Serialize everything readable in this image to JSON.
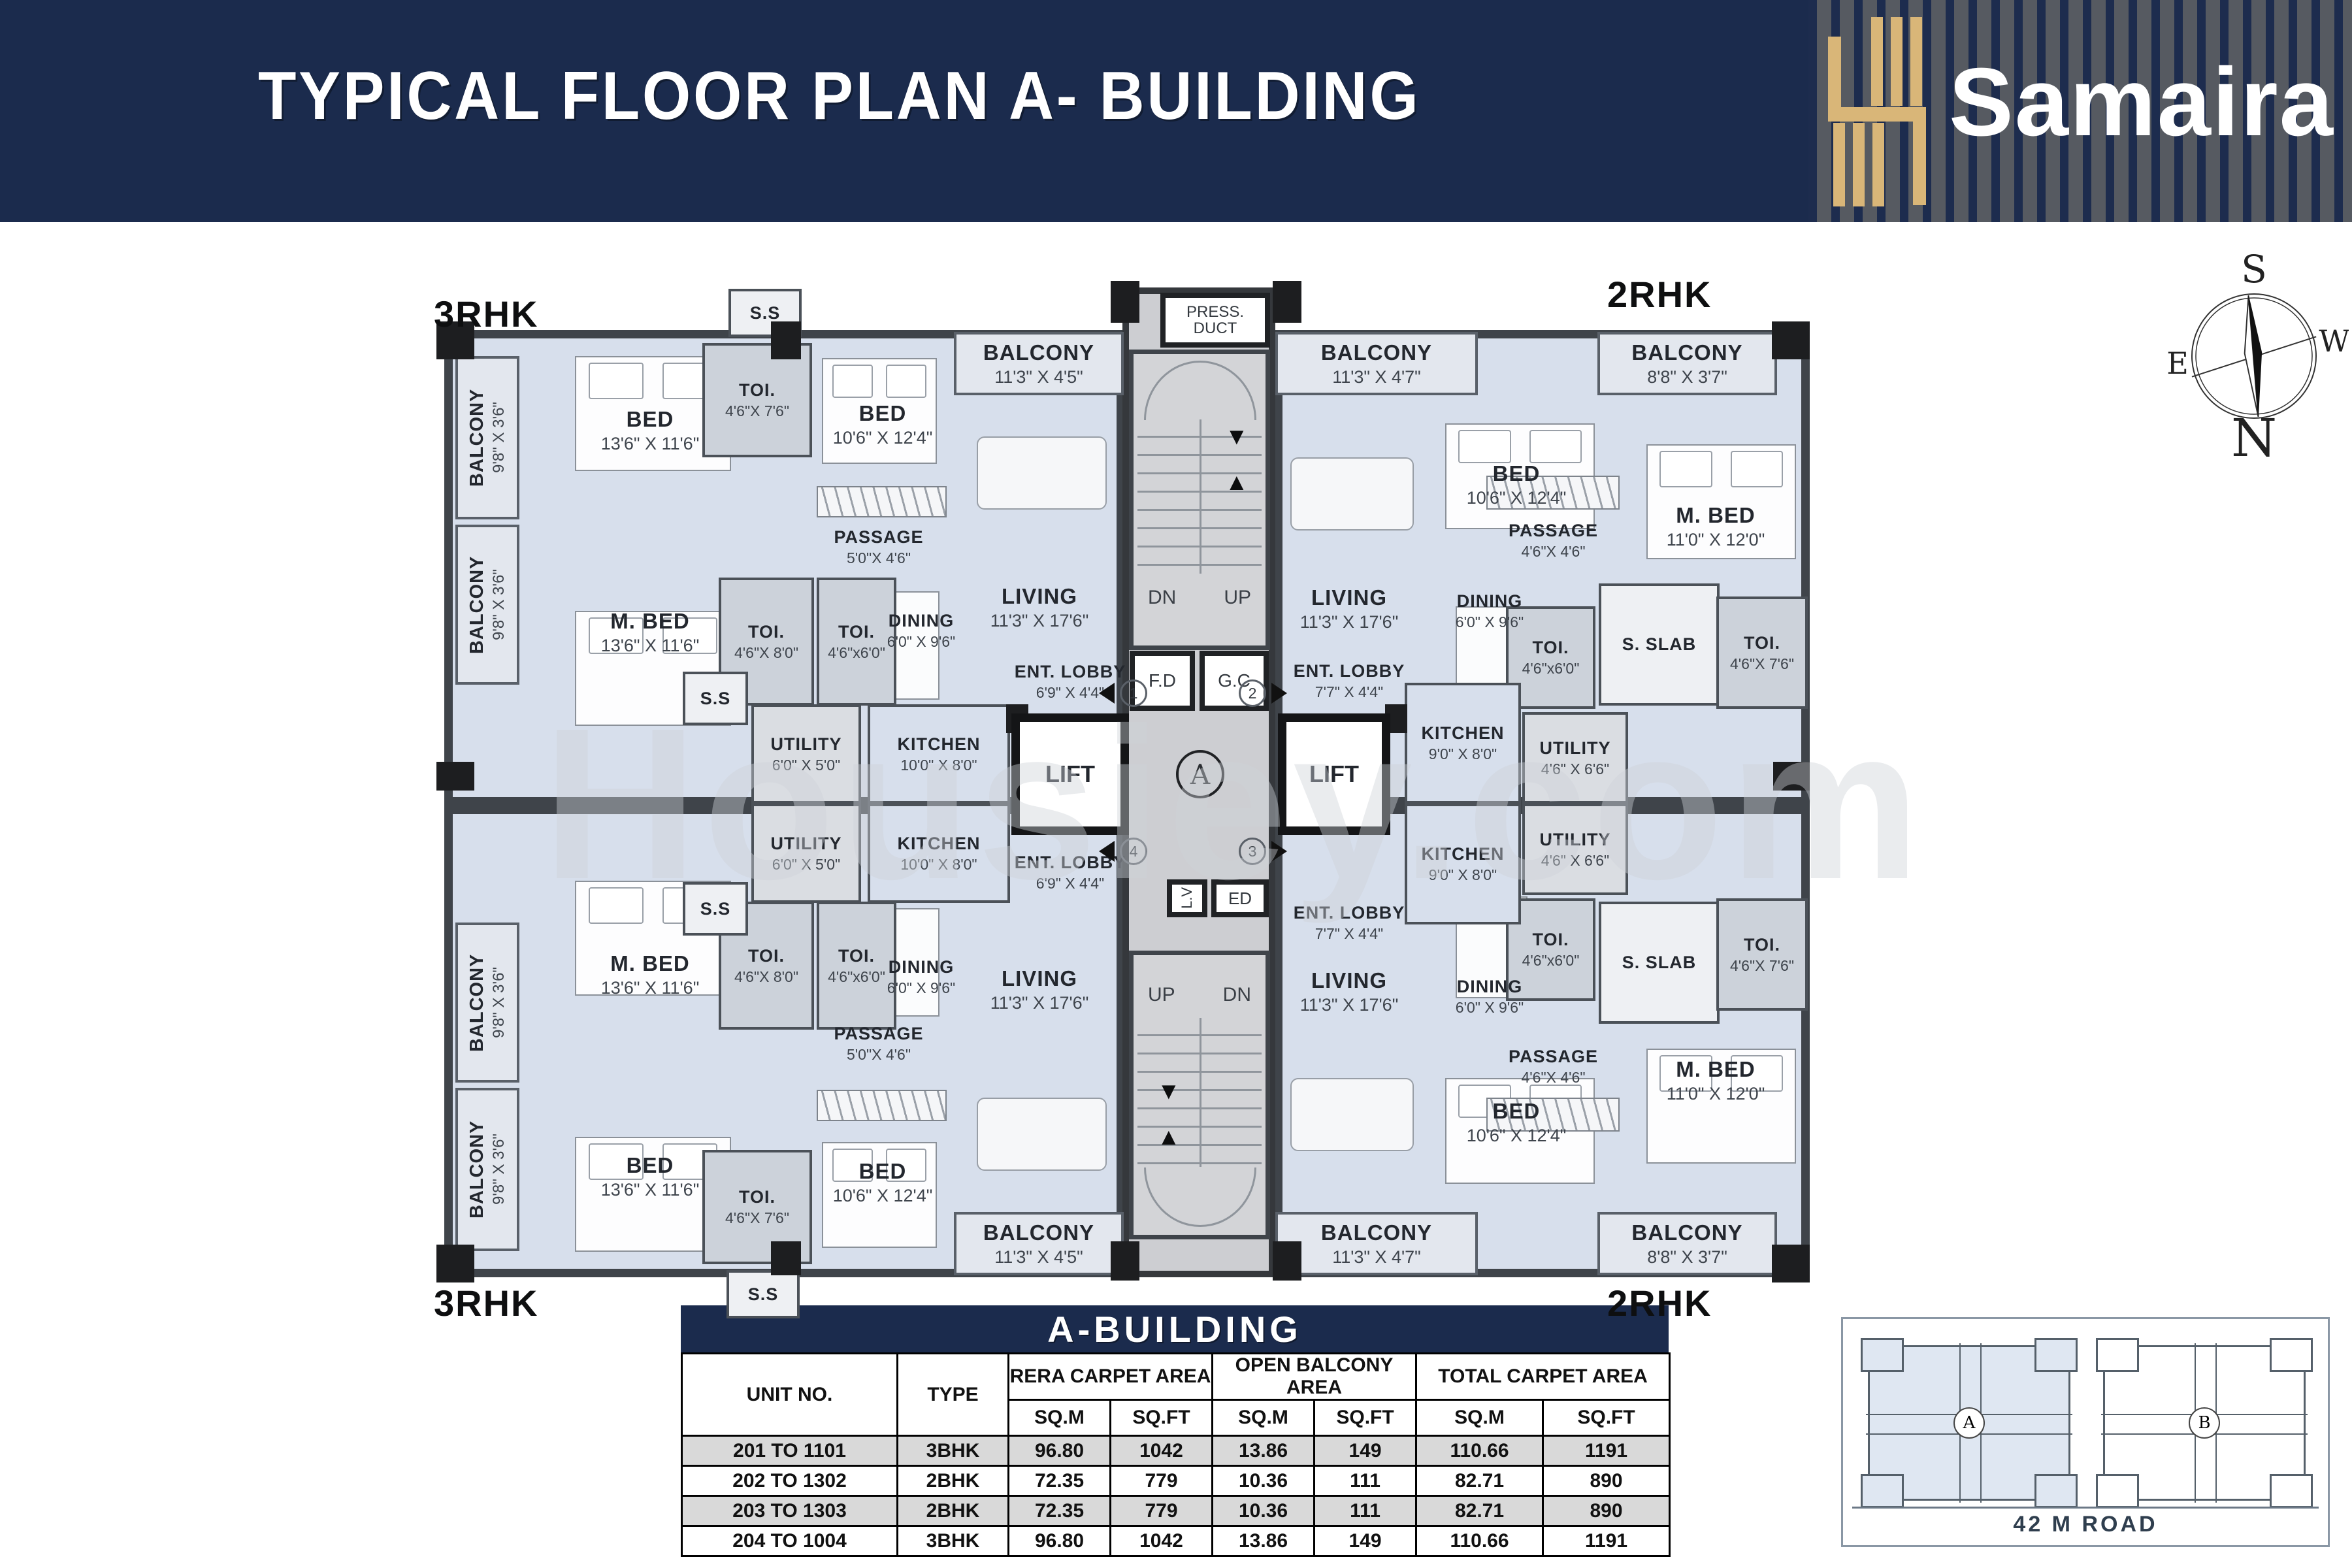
{
  "colors": {
    "navy": "#1b2b4d",
    "gold": "#d9b678",
    "room_fill": "#d7dfec",
    "balcony_fill": "#e3e7ee",
    "toilet_fill": "#ccd2da",
    "core_fill": "#cdced2",
    "wall": "#3f444a",
    "table_alt_row": "#d9d9d9"
  },
  "header": {
    "title": "TYPICAL FLOOR PLAN A- BUILDING",
    "brand": "Samaira"
  },
  "compass": {
    "n": "N",
    "s": "S",
    "e": "E",
    "w": "W"
  },
  "watermark": "Housiey.com",
  "plan": {
    "unit_labels": {
      "tl": "3RHK",
      "tr": "2RHK",
      "bl": "3RHK",
      "br": "2RHK"
    },
    "core": {
      "press_duct": "PRESS. DUCT",
      "dn": "DN",
      "up": "UP",
      "fd": "F.D",
      "gc": "G.C",
      "lift": "LIFT",
      "lv": "L.V",
      "ed": "ED",
      "badge": "A",
      "m1": "1",
      "m2": "2",
      "m3": "3",
      "m4": "4"
    },
    "rooms": [
      {
        "name": "BALCONY",
        "dims": "9'8\" X 3'6\""
      },
      {
        "name": "BALCONY",
        "dims": "9'8\" X 3'6\""
      },
      {
        "name": "BED",
        "dims": "13'6\" X 11'6\""
      },
      {
        "name": "M. BED",
        "dims": "13'6\" X 11'6\""
      },
      {
        "name": "S.S",
        "dims": ""
      },
      {
        "name": "TOI.",
        "dims": "4'6\"X 7'6\""
      },
      {
        "name": "BED",
        "dims": "10'6\" X 12'4\""
      },
      {
        "name": "PASSAGE",
        "dims": "5'0\"X 4'6\""
      },
      {
        "name": "TOI.",
        "dims": "4'6\"X 8'0\""
      },
      {
        "name": "TOI.",
        "dims": "4'6\"x6'0\""
      },
      {
        "name": "DINING",
        "dims": "6'0\" X 9'6\""
      },
      {
        "name": "S.S",
        "dims": ""
      },
      {
        "name": "UTILITY",
        "dims": "6'0\" X 5'0\""
      },
      {
        "name": "KITCHEN",
        "dims": "10'0\" X 8'0\""
      },
      {
        "name": "BALCONY",
        "dims": "11'3\" X 4'5\""
      },
      {
        "name": "LIVING",
        "dims": "11'3\" X 17'6\""
      },
      {
        "name": "ENT. LOBBY",
        "dims": "6'9\" X 4'4\""
      },
      {
        "name": "BALCONY",
        "dims": "11'3\" X 4'7\""
      },
      {
        "name": "BALCONY",
        "dims": "8'8\" X 3'7\""
      },
      {
        "name": "BED",
        "dims": "10'6\" X 12'4\""
      },
      {
        "name": "M. BED",
        "dims": "11'0\" X 12'0\""
      },
      {
        "name": "PASSAGE",
        "dims": "4'6\"X 4'6\""
      },
      {
        "name": "DINING",
        "dims": "6'0\" X 9'6\""
      },
      {
        "name": "LIVING",
        "dims": "11'3\" X 17'6\""
      },
      {
        "name": "ENT. LOBBY",
        "dims": "7'7\" X 4'4\""
      },
      {
        "name": "TOI.",
        "dims": "4'6\"x6'0\""
      },
      {
        "name": "S. SLAB",
        "dims": ""
      },
      {
        "name": "TOI.",
        "dims": "4'6\"X 7'6\""
      },
      {
        "name": "KITCHEN",
        "dims": "9'0\" X 8'0\""
      },
      {
        "name": "UTILITY",
        "dims": "4'6\" X 6'6\""
      },
      {
        "name": "BALCONY",
        "dims": "9'8\" X 3'6\""
      },
      {
        "name": "BALCONY",
        "dims": "9'8\" X 3'6\""
      },
      {
        "name": "BED",
        "dims": "13'6\" X 11'6\""
      },
      {
        "name": "M. BED",
        "dims": "13'6\" X 11'6\""
      },
      {
        "name": "S.S",
        "dims": ""
      },
      {
        "name": "TOI.",
        "dims": "4'6\"X 7'6\""
      },
      {
        "name": "BED",
        "dims": "10'6\" X 12'4\""
      },
      {
        "name": "PASSAGE",
        "dims": "5'0\"X 4'6\""
      },
      {
        "name": "TOI.",
        "dims": "4'6\"X 8'0\""
      },
      {
        "name": "TOI.",
        "dims": "4'6\"x6'0\""
      },
      {
        "name": "DINING",
        "dims": "6'0\" X 9'6\""
      },
      {
        "name": "S.S",
        "dims": ""
      },
      {
        "name": "UTILITY",
        "dims": "6'0\" X 5'0\""
      },
      {
        "name": "KITCHEN",
        "dims": "10'0\" X 8'0\""
      },
      {
        "name": "BALCONY",
        "dims": "11'3\" X 4'5\""
      },
      {
        "name": "LIVING",
        "dims": "11'3\" X 17'6\""
      },
      {
        "name": "ENT. LOBBY",
        "dims": "6'9\" X 4'4\""
      },
      {
        "name": "BALCONY",
        "dims": "11'3\" X 4'7\""
      },
      {
        "name": "BALCONY",
        "dims": "8'8\" X 3'7\""
      },
      {
        "name": "BED",
        "dims": "10'6\" X 12'4\""
      },
      {
        "name": "M. BED",
        "dims": "11'0\" X 12'0\""
      },
      {
        "name": "PASSAGE",
        "dims": "4'6\"X 4'6\""
      },
      {
        "name": "DINING",
        "dims": "6'0\" X 9'6\""
      },
      {
        "name": "LIVING",
        "dims": "11'3\" X 17'6\""
      },
      {
        "name": "ENT. LOBBY",
        "dims": "7'7\" X 4'4\""
      },
      {
        "name": "TOI.",
        "dims": "4'6\"x6'0\""
      },
      {
        "name": "S. SLAB",
        "dims": ""
      },
      {
        "name": "TOI.",
        "dims": "4'6\"X 7'6\""
      },
      {
        "name": "KITCHEN",
        "dims": "9'0\" X 8'0\""
      },
      {
        "name": "UTILITY",
        "dims": "4'6\" X 6'6\""
      }
    ]
  },
  "key_map": {
    "badge_a": "A",
    "badge_b": "B",
    "road": "42 M ROAD"
  },
  "table": {
    "title": "A-BUILDING",
    "columns": [
      "UNIT NO.",
      "TYPE",
      "RERA CARPET AREA",
      "OPEN BALCONY AREA",
      "TOTAL CARPET AREA"
    ],
    "sub_columns": [
      "SQ.M",
      "SQ.FT"
    ],
    "rows": [
      {
        "unit": "201 TO 1101",
        "type": "3BHK",
        "rera_sqm": "96.80",
        "rera_sqft": "1042",
        "balcony_sqm": "13.86",
        "balcony_sqft": "149",
        "total_sqm": "110.66",
        "total_sqft": "1191"
      },
      {
        "unit": "202 TO 1302",
        "type": "2BHK",
        "rera_sqm": "72.35",
        "rera_sqft": "779",
        "balcony_sqm": "10.36",
        "balcony_sqft": "111",
        "total_sqm": "82.71",
        "total_sqft": "890"
      },
      {
        "unit": "203 TO 1303",
        "type": "2BHK",
        "rera_sqm": "72.35",
        "rera_sqft": "779",
        "balcony_sqm": "10.36",
        "balcony_sqft": "111",
        "total_sqm": "82.71",
        "total_sqft": "890"
      },
      {
        "unit": "204 TO 1004",
        "type": "3BHK",
        "rera_sqm": "96.80",
        "rera_sqft": "1042",
        "balcony_sqm": "13.86",
        "balcony_sqft": "149",
        "total_sqm": "110.66",
        "total_sqft": "1191"
      }
    ]
  }
}
